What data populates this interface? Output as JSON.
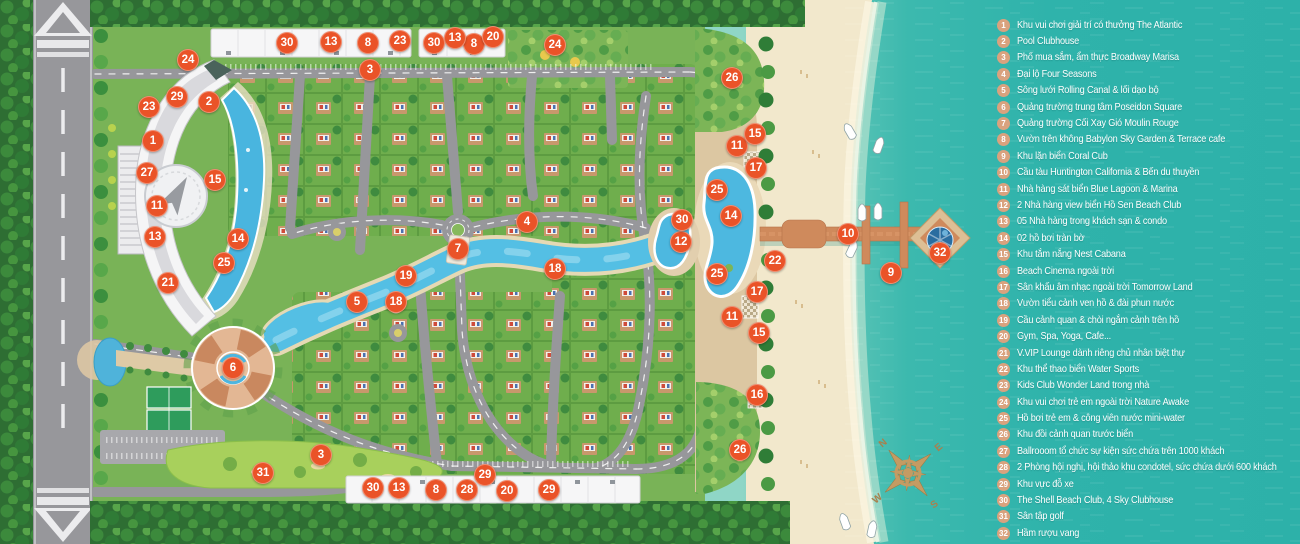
{
  "colors": {
    "marker": "#ea5328",
    "legend_badge": "#d9a27e",
    "sea": "#2fb3ab",
    "sand": "#f2e8cc",
    "canal": "#54bfe4",
    "pier": "#cf8a5c"
  },
  "map": {
    "road_label": "POLARIS RD.",
    "compass": {
      "n": "N",
      "e": "E",
      "s": "S",
      "w": "W"
    },
    "markers": [
      {
        "n": 1,
        "x": 153,
        "y": 141
      },
      {
        "n": 2,
        "x": 209,
        "y": 102
      },
      {
        "n": 3,
        "x": 370,
        "y": 70
      },
      {
        "n": 3,
        "x": 321,
        "y": 455
      },
      {
        "n": 4,
        "x": 527,
        "y": 222
      },
      {
        "n": 5,
        "x": 357,
        "y": 302
      },
      {
        "n": 6,
        "x": 233,
        "y": 368
      },
      {
        "n": 7,
        "x": 458,
        "y": 249
      },
      {
        "n": 8,
        "x": 368,
        "y": 43
      },
      {
        "n": 8,
        "x": 474,
        "y": 44
      },
      {
        "n": 8,
        "x": 436,
        "y": 490
      },
      {
        "n": 9,
        "x": 891,
        "y": 273
      },
      {
        "n": 10,
        "x": 848,
        "y": 234
      },
      {
        "n": 11,
        "x": 157,
        "y": 206
      },
      {
        "n": 11,
        "x": 737,
        "y": 146
      },
      {
        "n": 11,
        "x": 732,
        "y": 317
      },
      {
        "n": 12,
        "x": 681,
        "y": 242
      },
      {
        "n": 13,
        "x": 155,
        "y": 237
      },
      {
        "n": 13,
        "x": 331,
        "y": 42
      },
      {
        "n": 13,
        "x": 455,
        "y": 38
      },
      {
        "n": 13,
        "x": 399,
        "y": 488
      },
      {
        "n": 14,
        "x": 238,
        "y": 239
      },
      {
        "n": 14,
        "x": 731,
        "y": 216
      },
      {
        "n": 15,
        "x": 215,
        "y": 180
      },
      {
        "n": 15,
        "x": 755,
        "y": 134
      },
      {
        "n": 15,
        "x": 759,
        "y": 333
      },
      {
        "n": 16,
        "x": 757,
        "y": 395
      },
      {
        "n": 17,
        "x": 756,
        "y": 168
      },
      {
        "n": 17,
        "x": 757,
        "y": 292
      },
      {
        "n": 18,
        "x": 555,
        "y": 269
      },
      {
        "n": 18,
        "x": 396,
        "y": 302
      },
      {
        "n": 19,
        "x": 406,
        "y": 276
      },
      {
        "n": 20,
        "x": 493,
        "y": 37
      },
      {
        "n": 20,
        "x": 507,
        "y": 491
      },
      {
        "n": 21,
        "x": 168,
        "y": 283
      },
      {
        "n": 22,
        "x": 775,
        "y": 261
      },
      {
        "n": 23,
        "x": 149,
        "y": 107
      },
      {
        "n": 23,
        "x": 400,
        "y": 41
      },
      {
        "n": 24,
        "x": 188,
        "y": 60
      },
      {
        "n": 24,
        "x": 555,
        "y": 45
      },
      {
        "n": 25,
        "x": 224,
        "y": 263
      },
      {
        "n": 25,
        "x": 717,
        "y": 190
      },
      {
        "n": 25,
        "x": 717,
        "y": 274
      },
      {
        "n": 26,
        "x": 732,
        "y": 78
      },
      {
        "n": 26,
        "x": 740,
        "y": 450
      },
      {
        "n": 27,
        "x": 147,
        "y": 173
      },
      {
        "n": 28,
        "x": 467,
        "y": 490
      },
      {
        "n": 29,
        "x": 177,
        "y": 97
      },
      {
        "n": 29,
        "x": 485,
        "y": 475
      },
      {
        "n": 29,
        "x": 549,
        "y": 490
      },
      {
        "n": 30,
        "x": 287,
        "y": 43
      },
      {
        "n": 30,
        "x": 434,
        "y": 43
      },
      {
        "n": 30,
        "x": 682,
        "y": 220
      },
      {
        "n": 30,
        "x": 373,
        "y": 488
      },
      {
        "n": 31,
        "x": 263,
        "y": 473
      },
      {
        "n": 32,
        "x": 940,
        "y": 253
      }
    ]
  },
  "legend": {
    "items": [
      {
        "n": 1,
        "text": "Khu vui chơi giải trí có thưởng The Atlantic"
      },
      {
        "n": 2,
        "text": "Pool Clubhouse"
      },
      {
        "n": 3,
        "text": "Phố mua sắm, ẩm thực Broadway Marisa"
      },
      {
        "n": 4,
        "text": "Đại lộ Four Seasons"
      },
      {
        "n": 5,
        "text": "Sông lưới Rolling Canal & lối dạo bộ"
      },
      {
        "n": 6,
        "text": "Quảng trường trung tâm Poseidon Square"
      },
      {
        "n": 7,
        "text": "Quảng trường Cối Xay Gió Moulin Rouge"
      },
      {
        "n": 8,
        "text": "Vườn trên không Babylon Sky Garden & Terrace cafe"
      },
      {
        "n": 9,
        "text": "Khu lặn biển Coral Cub"
      },
      {
        "n": 10,
        "text": "Cầu tàu Huntington California & Bến du thuyền"
      },
      {
        "n": 11,
        "text": "Nhà hàng sát biển Blue Lagoon & Marina"
      },
      {
        "n": 12,
        "text": "2 Nhà hàng view biển Hồ Sen Beach Club"
      },
      {
        "n": 13,
        "text": "05 Nhà hàng trong khách sạn & condo"
      },
      {
        "n": 14,
        "text": "02 hồ bơi tràn bờ"
      },
      {
        "n": 15,
        "text": "Khu tắm nắng Nest Cabana"
      },
      {
        "n": 16,
        "text": "Beach Cinema ngoài trời"
      },
      {
        "n": 17,
        "text": "Sân khấu âm nhạc ngoài trời Tomorrow Land"
      },
      {
        "n": 18,
        "text": "Vườn tiểu cảnh ven hồ & đài phun nước"
      },
      {
        "n": 19,
        "text": "Cầu cảnh quan & chòi ngắm cảnh trên hồ"
      },
      {
        "n": 20,
        "text": "Gym, Spa, Yoga, Cafe..."
      },
      {
        "n": 21,
        "text": "V.VIP Lounge dành riêng chủ nhân biệt thự"
      },
      {
        "n": 22,
        "text": "Khu thể thao biển Water Sports"
      },
      {
        "n": 23,
        "text": "Kids Club Wonder Land trong nhà"
      },
      {
        "n": 24,
        "text": "Khu vui chơi trẻ em ngoài trời Nature Awake"
      },
      {
        "n": 25,
        "text": "Hồ bơi trẻ em & công viên nước mini-water"
      },
      {
        "n": 26,
        "text": "Khu đồi cảnh quan trước biển"
      },
      {
        "n": 27,
        "text": "Ballrooom tổ chức sự kiện sức chứa trên 1000 khách"
      },
      {
        "n": 28,
        "text": "2 Phòng hội nghị, hội thảo khu condotel, sức chứa dưới 600 khách"
      },
      {
        "n": 29,
        "text": "Khu vực đỗ xe"
      },
      {
        "n": 30,
        "text": "The Shell Beach Club, 4 Sky Clubhouse"
      },
      {
        "n": 31,
        "text": "Sân tập golf"
      },
      {
        "n": 32,
        "text": "Hầm rượu vang"
      }
    ]
  }
}
